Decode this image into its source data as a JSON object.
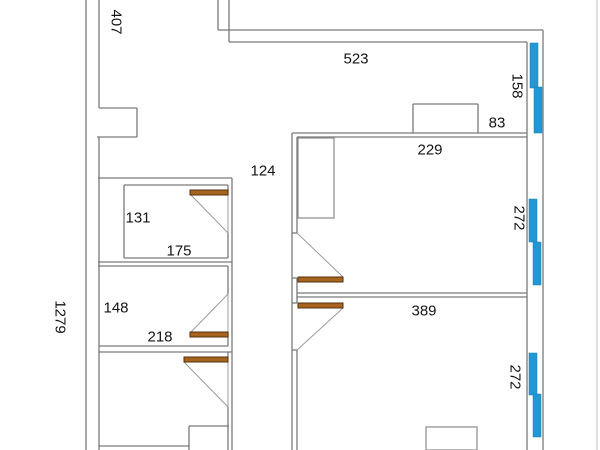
{
  "title": "floor-plan-dimension-drawing",
  "colors": {
    "background": "#ffffff",
    "wall": "#7a7a7a",
    "swing": "#9c9c9c",
    "canvas_edge": "#bdbdbd",
    "door_fill": "#a8641e",
    "door_border": "#533211",
    "window_fill": "#2397d4",
    "window_border": "#1b7fb4",
    "furniture": "#8a8a8a",
    "text": "#141414"
  },
  "plan": {
    "width": 600,
    "height": 450,
    "labels": [
      {
        "text": "407",
        "x": 116,
        "y": 22,
        "rot": true
      },
      {
        "text": "523",
        "x": 356,
        "y": 59,
        "rot": false
      },
      {
        "text": "158",
        "x": 517,
        "y": 86,
        "rot": true
      },
      {
        "text": "83",
        "x": 497,
        "y": 123,
        "rot": false
      },
      {
        "text": "229",
        "x": 430,
        "y": 150,
        "rot": false
      },
      {
        "text": "124",
        "x": 263,
        "y": 171,
        "rot": false
      },
      {
        "text": "131",
        "x": 138,
        "y": 218,
        "rot": false
      },
      {
        "text": "175",
        "x": 179,
        "y": 251,
        "rot": false
      },
      {
        "text": "1279",
        "x": 60,
        "y": 317,
        "rot": true
      },
      {
        "text": "148",
        "x": 116,
        "y": 308,
        "rot": false
      },
      {
        "text": "218",
        "x": 160,
        "y": 337,
        "rot": false
      },
      {
        "text": "272",
        "x": 519,
        "y": 218,
        "rot": true
      },
      {
        "text": "389",
        "x": 424,
        "y": 311,
        "rot": false
      },
      {
        "text": "272",
        "x": 515,
        "y": 377,
        "rot": true
      }
    ],
    "walls": [
      [
        86,
        0,
        86,
        450
      ],
      [
        99,
        0,
        99,
        108
      ],
      [
        99,
        108,
        137,
        108
      ],
      [
        137,
        108,
        137,
        137
      ],
      [
        97,
        137,
        137,
        137
      ],
      [
        99,
        137,
        99,
        450
      ],
      [
        218,
        0,
        218,
        30
      ],
      [
        229,
        0,
        229,
        42
      ],
      [
        218,
        30,
        543,
        30
      ],
      [
        229,
        42,
        527,
        42
      ],
      [
        543,
        30,
        543,
        450
      ],
      [
        527,
        42,
        527,
        450
      ],
      [
        292,
        133,
        527,
        133
      ],
      [
        297,
        137,
        527,
        137
      ],
      [
        413,
        104,
        413,
        133
      ],
      [
        413,
        104,
        478,
        104
      ],
      [
        478,
        104,
        478,
        133
      ],
      [
        292,
        133,
        292,
        450
      ],
      [
        297,
        137,
        297,
        233
      ],
      [
        297,
        278,
        297,
        303
      ],
      [
        297,
        350,
        297,
        450
      ],
      [
        297,
        293,
        527,
        293
      ],
      [
        297,
        297,
        527,
        297
      ],
      [
        98,
        178,
        232,
        178
      ],
      [
        232,
        178,
        232,
        450
      ],
      [
        124,
        185,
        228,
        185
      ],
      [
        124,
        185,
        124,
        258
      ],
      [
        124,
        258,
        228,
        258
      ],
      [
        228,
        185,
        228,
        195
      ],
      [
        228,
        233,
        228,
        258
      ],
      [
        98,
        262,
        232,
        262
      ],
      [
        98,
        266,
        228,
        266
      ],
      [
        228,
        266,
        228,
        294
      ],
      [
        228,
        332,
        228,
        346
      ],
      [
        99,
        346,
        228,
        346
      ],
      [
        99,
        352,
        232,
        352
      ],
      [
        228,
        352,
        228,
        357
      ],
      [
        228,
        407,
        228,
        426
      ],
      [
        189,
        426,
        229,
        426
      ],
      [
        189,
        426,
        189,
        450
      ],
      [
        228,
        426,
        228,
        450
      ],
      [
        99,
        446,
        189,
        446
      ],
      [
        292,
        233,
        297,
        233
      ],
      [
        292,
        278,
        297,
        278
      ],
      [
        292,
        303,
        297,
        303
      ],
      [
        292,
        350,
        297,
        350
      ]
    ],
    "swings": [
      [
        191,
        195,
        228,
        233
      ],
      [
        228,
        195,
        228,
        233
      ],
      [
        191,
        332,
        228,
        294
      ],
      [
        228,
        294,
        228,
        332
      ],
      [
        184,
        362,
        228,
        407
      ],
      [
        228,
        362,
        228,
        407
      ],
      [
        297,
        233,
        343,
        277
      ],
      [
        343,
        308,
        297,
        350
      ]
    ],
    "door_panels": [
      [
        190,
        190,
        38,
        5
      ],
      [
        190,
        332,
        38,
        5
      ],
      [
        184,
        357,
        44,
        5
      ],
      [
        298,
        277,
        45,
        5
      ],
      [
        298,
        303,
        45,
        5
      ]
    ],
    "windows": [
      [
        530,
        43,
        8,
        45
      ],
      [
        534,
        87,
        8,
        46
      ],
      [
        529,
        199,
        8,
        43
      ],
      [
        533,
        242,
        8,
        43
      ],
      [
        529,
        353,
        8,
        42
      ],
      [
        533,
        394,
        8,
        43
      ]
    ],
    "furniture": [
      [
        298,
        138,
        36,
        80
      ],
      [
        426,
        427,
        51,
        23
      ]
    ],
    "canvas_edge": [
      597,
      0,
      597,
      450
    ]
  }
}
